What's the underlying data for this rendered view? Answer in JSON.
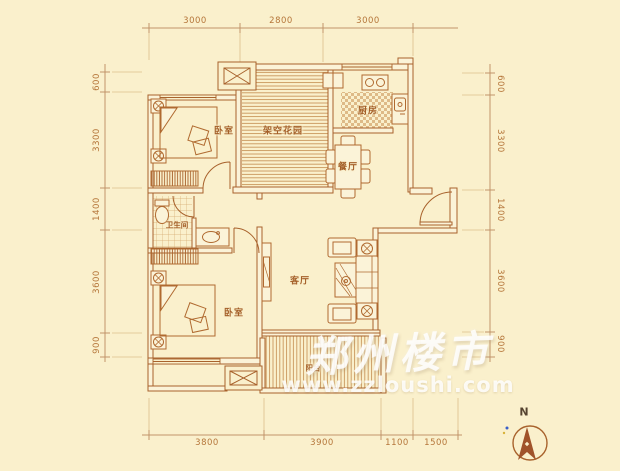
{
  "theme": {
    "bg": "#faf0cc",
    "line": "#a8622c",
    "dim-text": "#b5763a",
    "label": "#a45f28"
  },
  "dimensions": {
    "top": [
      "3000",
      "2800",
      "3000"
    ],
    "bottom": [
      "3800",
      "3900",
      "1100",
      "1500"
    ],
    "left": [
      "600",
      "3300",
      "1400",
      "3600",
      "900"
    ],
    "right": [
      "600",
      "3300",
      "1400",
      "3600",
      "900"
    ]
  },
  "rooms": {
    "bedroom1": "卧室",
    "garden": "架空花园",
    "kitchen": "厨房",
    "dining": "餐厅",
    "bathroom": "卫生间",
    "living": "客厅",
    "bedroom2": "卧室",
    "balcony": "阳台"
  },
  "watermark": {
    "title": "郑州楼市",
    "url": "www.zzloushi.com"
  },
  "compass": {
    "label": "N"
  }
}
